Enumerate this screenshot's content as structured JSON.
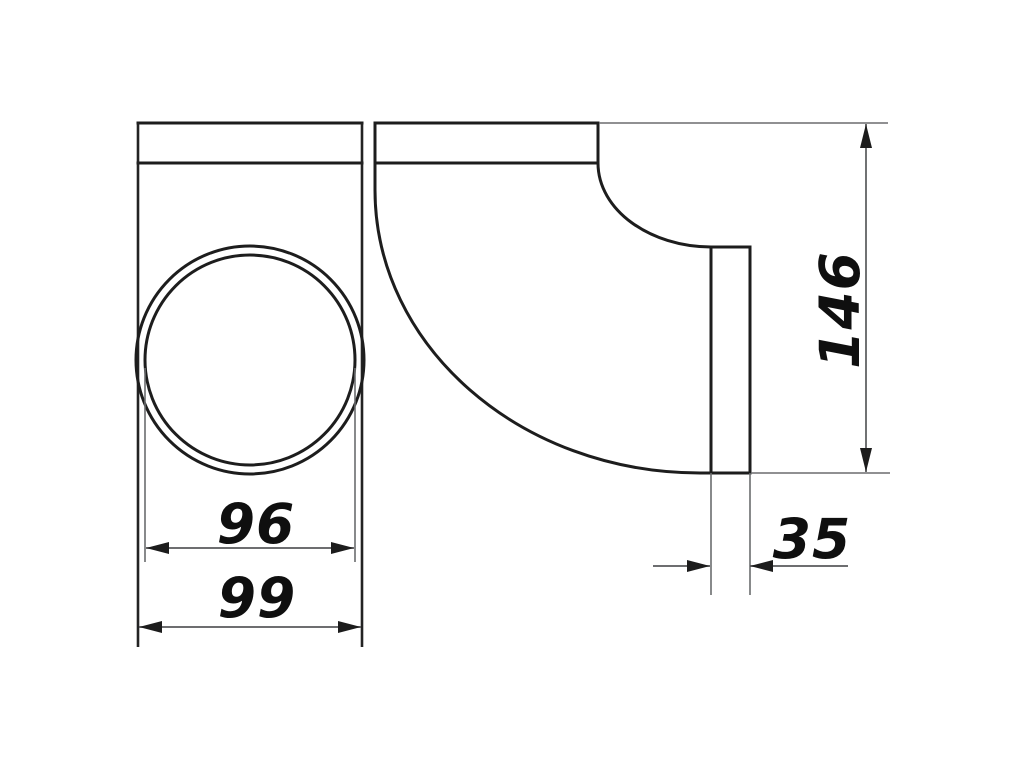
{
  "page": {
    "background": "#ffffff",
    "description": "Technical line drawing of a 90-degree elbow duct connector shown in two orthographic views"
  },
  "drawing": {
    "colors": {
      "outline": "#1d1d1d",
      "dimension_line": "#58595b",
      "arrowhead": "#1c1c1c",
      "text": "#0f0f0f"
    },
    "views": {
      "front": {
        "name": "front-view-round-spigot",
        "features": [
          "flange-bar",
          "body-sides",
          "outer-circle",
          "inner-circle"
        ]
      },
      "side": {
        "name": "side-view-elbow-profile",
        "features": [
          "flange-bar",
          "outer-curve",
          "inner-curve",
          "vertical-spigot"
        ]
      }
    },
    "dimensions": {
      "inner_diameter": "96",
      "flange_width": "99",
      "height": "146",
      "spigot_depth": "35"
    }
  }
}
